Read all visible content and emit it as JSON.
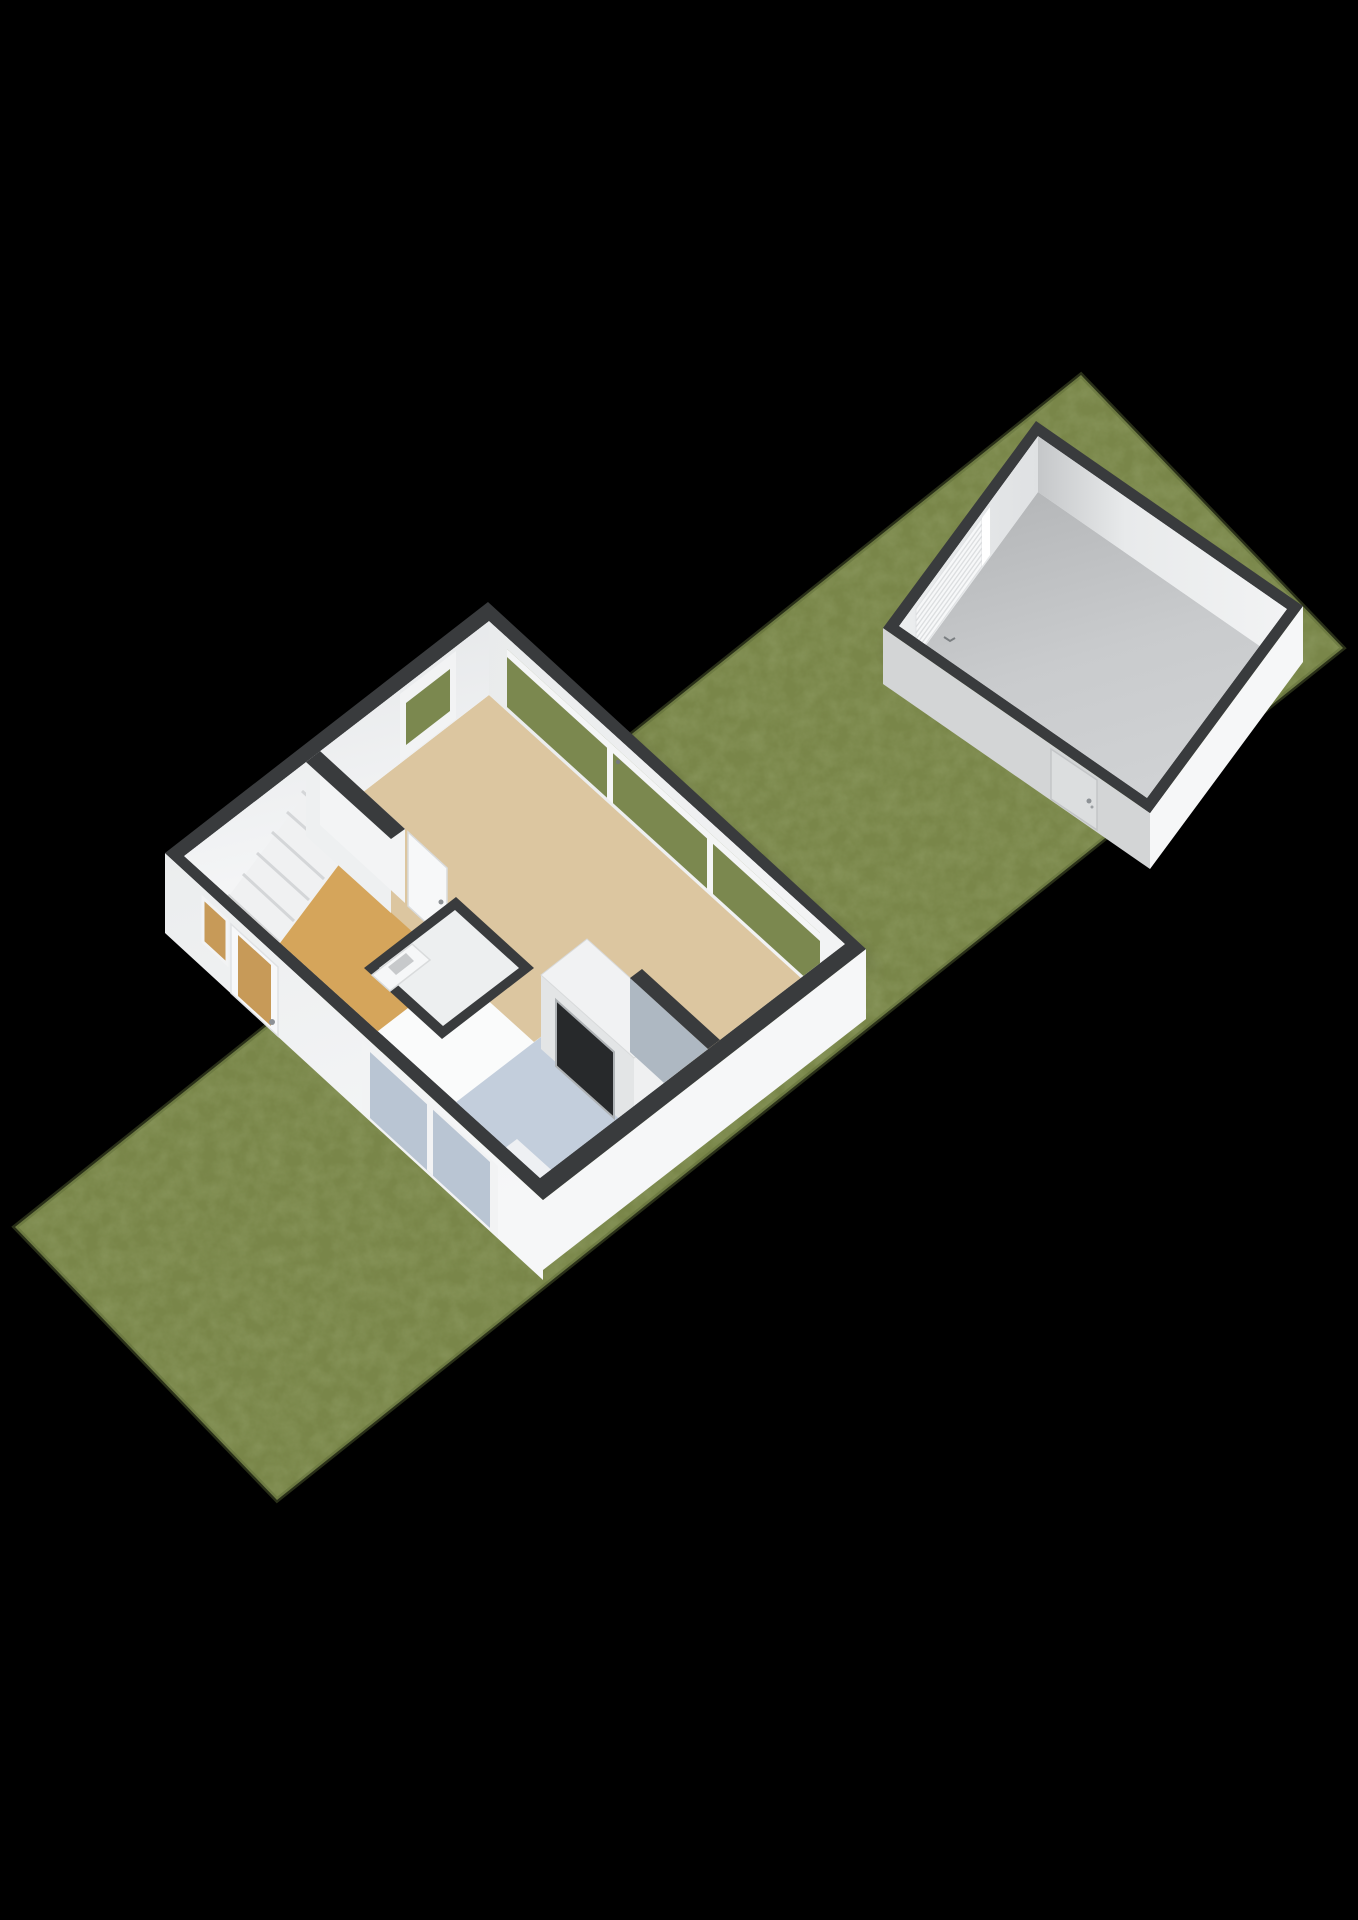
{
  "scene": {
    "type": "3d-floorplan-render",
    "view": "isometric-cutaway",
    "background_color": "#000000",
    "plot": {
      "name": "garden-plot",
      "surface": "grass"
    },
    "house": {
      "name": "house-ground-floor",
      "rooms": [
        {
          "name": "living-room",
          "floor": "tan"
        },
        {
          "name": "hallway",
          "floor": "wood"
        },
        {
          "name": "wc",
          "floor": "light-gray"
        },
        {
          "name": "kitchen",
          "floor": "blue-gray"
        }
      ],
      "features": [
        "staircase-7-steps",
        "interior-door-open",
        "partition-wall",
        "entry-door-glazed",
        "entry-sidelight",
        "kitchen-window",
        "sliding-garden-doors",
        "small-rear-window",
        "washbasin",
        "fridge-cabinet-unit",
        "kitchen-mat",
        "kitchen-partition-stub"
      ]
    },
    "garage": {
      "name": "detached-garage",
      "features": [
        "sectional-garage-door",
        "pedestrian-side-door",
        "concrete-floor"
      ]
    }
  },
  "colors": {
    "background": "#000000",
    "grass": "#798649",
    "grass_edge": "#5c6936",
    "wall_cap": "#393b3d",
    "wall_ext_light": "#d3d5d6",
    "wall_ext_white": "#f0f1f2",
    "wall_ext_bright": "#f6f7f8",
    "wall_int": "#eef0f1",
    "wall_int_face": "#f3f4f5",
    "floor_living": "#dcc6a0",
    "floor_hall": "#d5a55b",
    "floor_kitchen": "#c3cedc",
    "floor_wc": "#edeff0",
    "floor_base": "#fafbfb",
    "glass_grass": "#7b884f",
    "glass_hall": "#c79a58",
    "glass_kitchen": "#b9c5d3",
    "stairs": "#f0f1f2",
    "stair_riser": "#d4d6d8",
    "door_leaf": "#f7f8f9",
    "door_frame": "#d9dbdc",
    "garage_door": "#f7f8f9",
    "garage_door_slat": "#dcdee0",
    "side_door": "#dcdedf",
    "fridge_panel": "#27292b",
    "fridge_body": "#e3e5e6",
    "unit_top": "#f1f2f3",
    "stub_face": "#aeb8c2",
    "handle": "#8e9296",
    "basin_inset": "#c7c9cb"
  }
}
